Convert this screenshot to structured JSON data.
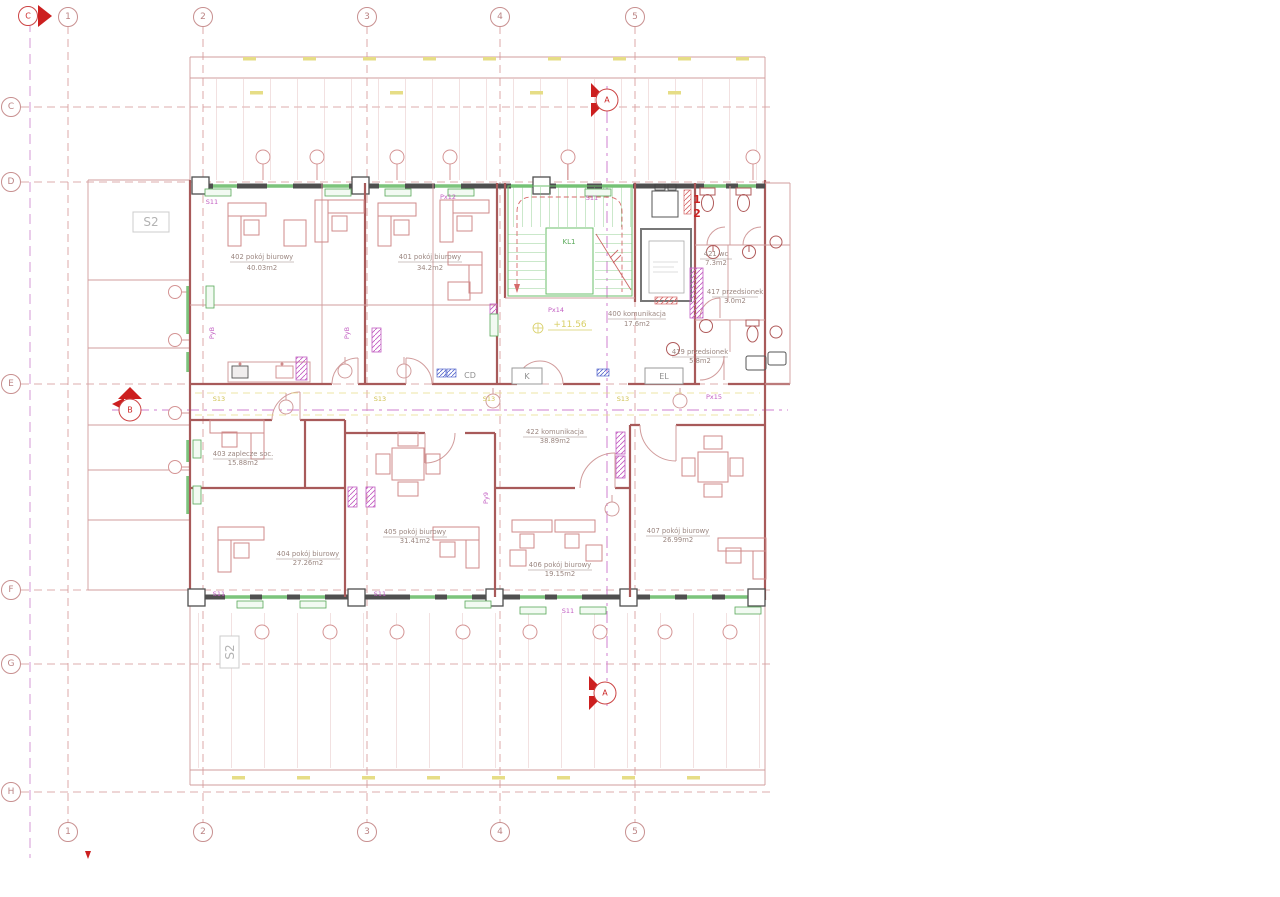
{
  "drawing": {
    "level_mark": "+11.56"
  },
  "grid": {
    "cols": [
      "1",
      "2",
      "3",
      "4",
      "5"
    ],
    "rows": [
      "C",
      "D",
      "E",
      "F",
      "G",
      "H"
    ]
  },
  "sections": {
    "a": "A",
    "b": "B",
    "c": "C"
  },
  "zones": {
    "s2": "S2"
  },
  "tags": {
    "s11": "S11",
    "s13": "S13"
  },
  "axis_tags": {
    "px12": "Px12",
    "px14": "Px14",
    "px15": "Px15",
    "pyb": "PyB",
    "py9": "Py9"
  },
  "core": {
    "stair": "KL1",
    "kitchen": "K",
    "electrical": "EL",
    "cd": "CD",
    "wc_num_1": "1",
    "wc_num_2": "2"
  },
  "rooms": {
    "r400": {
      "name": "400 komunikacja",
      "area": "17.6m2"
    },
    "r401": {
      "name": "401 pokój biurowy",
      "area": "34.2m2"
    },
    "r402": {
      "name": "402 pokój biurowy",
      "area": "40.03m2"
    },
    "r403": {
      "name": "403 zaplecze soc.",
      "area": "15.88m2"
    },
    "r404": {
      "name": "404 pokój biurowy",
      "area": "27.26m2"
    },
    "r405": {
      "name": "405 pokój biurowy",
      "area": "31.41m2"
    },
    "r406": {
      "name": "406 pokój biurowy",
      "area": "19.15m2"
    },
    "r407": {
      "name": "407 pokój biurowy",
      "area": "26.99m2"
    },
    "r417": {
      "name": "417 przedsionek",
      "area": "3.0m2"
    },
    "r419": {
      "name": "419 przedsionek",
      "area": "5.8m2"
    },
    "r421": {
      "name": "421 wc",
      "area": "7.3m2"
    },
    "r422": {
      "name": "422 komunikacja",
      "area": "38.89m2"
    }
  },
  "colors": {
    "wall_dark": "#4f4f4f",
    "wall_red": "#a85a5a",
    "green": "#58a858",
    "magenta": "#c25ec2",
    "yellow": "#d8c95f",
    "marker_red": "#cc1f1f"
  }
}
